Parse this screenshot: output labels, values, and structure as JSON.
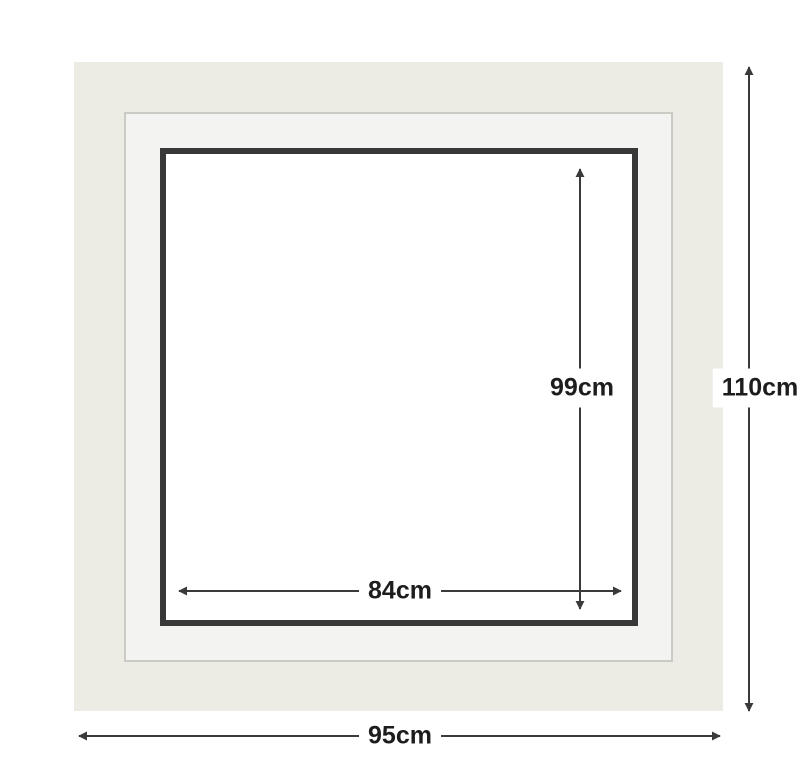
{
  "colors": {
    "canvas_bg": "#ffffff",
    "frame_face": "#ecebe4",
    "mat_face": "#f3f3f1",
    "mat_border": "#cbcbc6",
    "opening_face": "#ffffff",
    "frame_border": "#383838",
    "arrow": "#3a3a3a",
    "label_text": "#1d1d1d"
  },
  "diagram": {
    "dimensions": {
      "outer_height": {
        "label": "110cm"
      },
      "outer_width": {
        "label": "95cm"
      },
      "opening_height": {
        "label": "99cm"
      },
      "opening_width": {
        "label": "84cm"
      }
    }
  }
}
